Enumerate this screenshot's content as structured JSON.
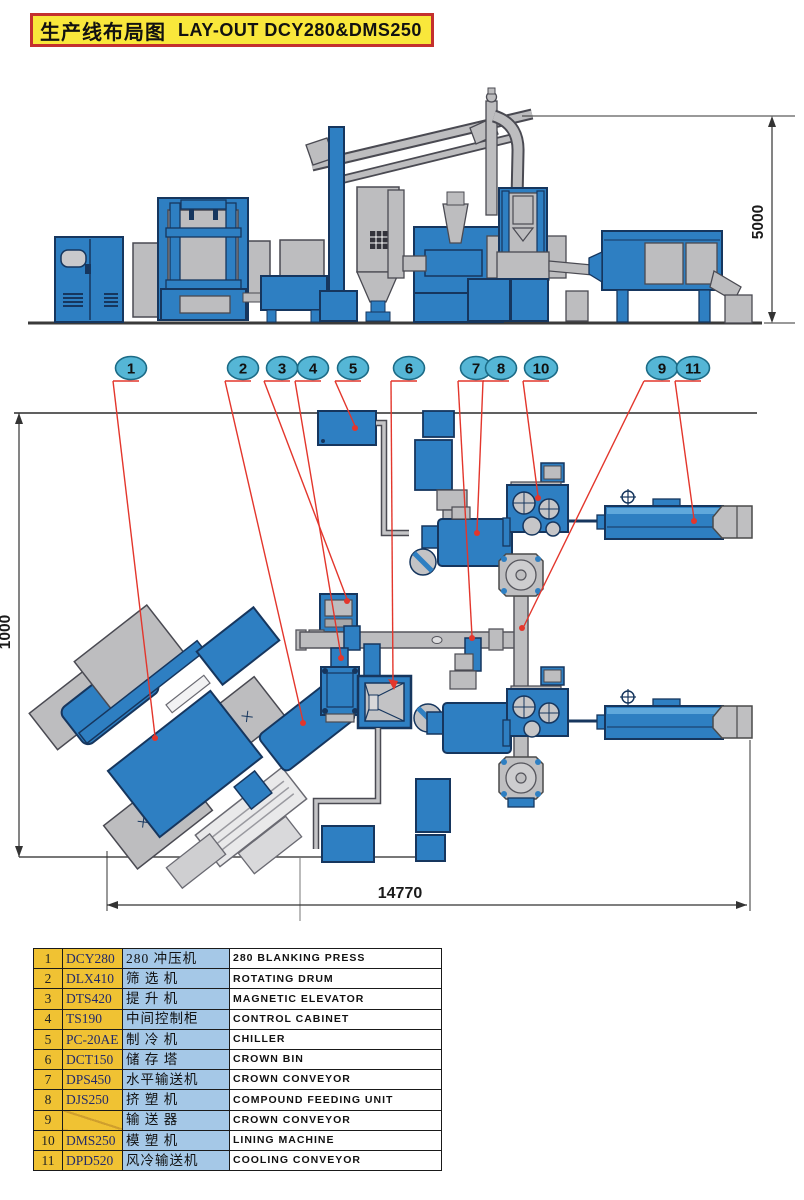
{
  "title": {
    "cn": "生产线布局图",
    "en": "LAY-OUT DCY280&DMS250"
  },
  "dimensions": {
    "elevation_height": "5000",
    "plan_depth": "1000",
    "plan_length": "14770"
  },
  "plan": {
    "callouts": [
      "1",
      "2",
      "3",
      "4",
      "5",
      "6",
      "7",
      "8",
      "10",
      "9",
      "11"
    ]
  },
  "colors": {
    "machine_blue": "#2e7fc2",
    "machine_gray": "#bdbdbf",
    "outline_navy": "#16365e",
    "leader_red": "#e3362c",
    "bubble_cyan": "#55b6d6",
    "table_yellow": "#f0c233",
    "table_blue": "#a5c8e7",
    "title_yellow": "#f9e73b",
    "title_border_red": "#c4302e"
  },
  "table": {
    "rows": [
      {
        "num": "1",
        "model": "DCY280",
        "cn": "280 冲压机",
        "en": "280 BLANKING PRESS"
      },
      {
        "num": "2",
        "model": "DLX410",
        "cn": "筛 选 机",
        "en": "ROTATING DRUM"
      },
      {
        "num": "3",
        "model": "DTS420",
        "cn": "提 升 机",
        "en": "MAGNETIC ELEVATOR"
      },
      {
        "num": "4",
        "model": "TS190",
        "cn": "中间控制柜",
        "en": "CONTROL CABINET"
      },
      {
        "num": "5",
        "model": "PC-20AE",
        "cn": "制 冷 机",
        "en": "CHILLER"
      },
      {
        "num": "6",
        "model": "DCT150",
        "cn": "储 存 塔",
        "en": "CROWN BIN"
      },
      {
        "num": "7",
        "model": "DPS450",
        "cn": "水平输送机",
        "en": "CROWN CONVEYOR"
      },
      {
        "num": "8",
        "model": "DJS250",
        "cn": "挤 塑 机",
        "en": "COMPOUND FEEDING UNIT"
      },
      {
        "num": "9",
        "model": "",
        "cn": "输 送 器",
        "en": "CROWN CONVEYOR"
      },
      {
        "num": "10",
        "model": "DMS250",
        "cn": "模 塑 机",
        "en": "LINING MACHINE"
      },
      {
        "num": "11",
        "model": "DPD520",
        "cn": "风冷输送机",
        "en": "COOLING CONVEYOR"
      }
    ]
  }
}
